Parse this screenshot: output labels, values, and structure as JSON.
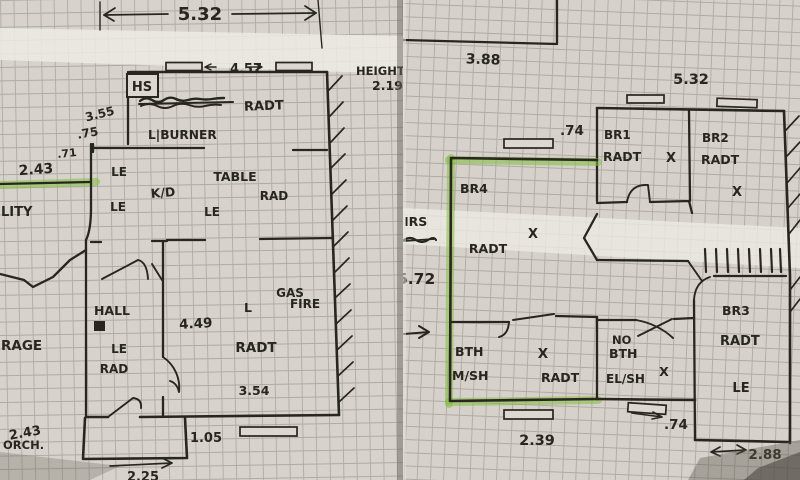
{
  "colors": {
    "paper": "#d7d3cc",
    "ink": "#29251f",
    "grid_line": "#8e8881",
    "highlighter_green": "#7fbe3e"
  },
  "left_plan": {
    "dim_top_width": "5.32",
    "dim_window_wall": "4.57",
    "height_label": "HEIGHT",
    "height_value": "2.19",
    "hs_label": "HS",
    "kitchen_radiator": "RADT",
    "dim_3_55": "3.55",
    "dim_0_75": ".75",
    "burner_label": "L|BURNER",
    "dim_0_71": ".71",
    "dim_2_43": "2.43",
    "le_top": "LE",
    "le_left": "LE",
    "le_center": "LE",
    "kd_label": "K/D",
    "table_label": "TABLE",
    "table_radiator": "RAD",
    "utility_label": "LITY",
    "hall_label": "HALL",
    "hall_le": "LE",
    "hall_radiator": "RAD",
    "garage_label": "RAGE",
    "gas_label": "GAS",
    "fire_label": "FIRE",
    "lounge_l": "L",
    "dim_4_49": "4.49",
    "lounge_radiator": "RADT",
    "dim_3_54": "3.54",
    "porch_dim": "2.43",
    "porch_label": "ORCH.",
    "dim_1_05": "1.05",
    "dim_2_25": "2.25"
  },
  "right_plan": {
    "dim_3_88": "3.88",
    "dim_5_32": "5.32",
    "dim_0_74_top": ".74",
    "br1_label": "BR1",
    "br1_radiator": "RADT",
    "br1_x": "X",
    "br2_label": "BR2",
    "br2_radiator": "RADT",
    "br2_x": "X",
    "br4_label": "BR4",
    "br4_radiator": "RADT",
    "br4_x": "X",
    "stairs_label": "IRS",
    "dim_5_72": "5.72",
    "bath_label": "BTH",
    "bath_shower": "M/SH",
    "bath_x": "X",
    "bath_radiator": "RADT",
    "no_bath_line1": "NO",
    "no_bath_line2": "BTH",
    "el_shower": "EL/SH",
    "no_bath_x": "X",
    "br3_label": "BR3",
    "br3_radiator": "RADT",
    "br3_le": "LE",
    "dim_2_39": "2.39",
    "dim_0_74_bottom": ".74",
    "dim_2_88": "2.88"
  }
}
